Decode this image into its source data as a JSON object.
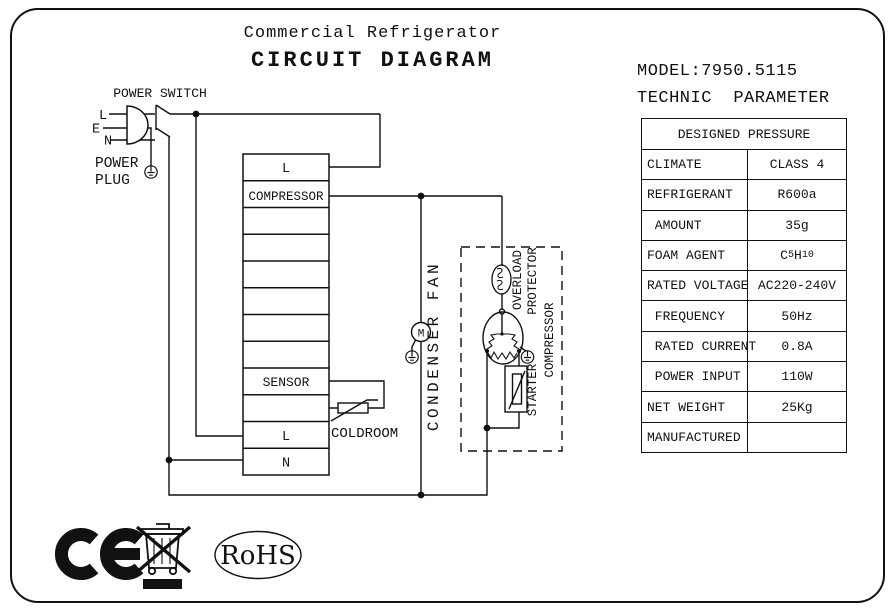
{
  "colors": {
    "ink": "#111111",
    "background": "#ffffff"
  },
  "title": {
    "line1": "Commercial Refrigerator",
    "line2": "CIRCUIT DIAGRAM"
  },
  "schematic": {
    "power_switch_label": "POWER SWITCH",
    "pin_l": "L",
    "pin_e": "E",
    "pin_n": "N",
    "power_plug_label_1": "POWER",
    "power_plug_label_2": "PLUG",
    "motor_letter": "M",
    "terminal_rows": [
      "L",
      "COMPRESSOR",
      "",
      "",
      "",
      "",
      "",
      "",
      "SENSOR",
      "",
      "L",
      "N"
    ],
    "coldroom_label": "COLDROOM",
    "condenser_fan_label": "CONDENSER FAN",
    "overload_label_1": "OVERLOAD",
    "overload_label_2": "PROTECTOR",
    "starter_label": "STARTER",
    "compressor_label": "COMPRESSOR",
    "icons": {
      "ground": "earth-ground-icon",
      "motor": "motor-circle-icon",
      "thermistor": "thermistor-icon",
      "overload": "overload-protector-icon",
      "ptc_starter": "ptc-starter-icon"
    }
  },
  "panel": {
    "model": "MODEL:7950.5115",
    "subtitle": "TECHNIC  PARAMETER",
    "table": {
      "header": "DESIGNED PRESSURE",
      "rows": [
        {
          "label": "CLIMATE",
          "value": "CLASS 4"
        },
        {
          "label": "REFRIGERANT",
          "value": "R600a"
        },
        {
          "label": " AMOUNT",
          "value": "35g"
        },
        {
          "label": "FOAM AGENT",
          "value": "C5H10",
          "value_formula": {
            "el1": "C",
            "sub1": "5",
            "el2": "H",
            "sub2": "10"
          }
        },
        {
          "label": "RATED VOLTAGE",
          "value": "AC220-240V"
        },
        {
          "label": " FREQUENCY",
          "value": "50Hz"
        },
        {
          "label": " RATED CURRENT",
          "value": "0.8A"
        },
        {
          "label": " POWER INPUT",
          "value": "110W"
        },
        {
          "label": "NET WEIGHT",
          "value": "25Kg"
        },
        {
          "label": "MANUFACTURED",
          "value": ""
        }
      ]
    }
  },
  "footer": {
    "rohs_label": "RoHS",
    "icons": {
      "ce": "ce-mark-icon",
      "weee": "weee-crossed-bin-icon",
      "rohs": "rohs-badge-icon"
    }
  }
}
